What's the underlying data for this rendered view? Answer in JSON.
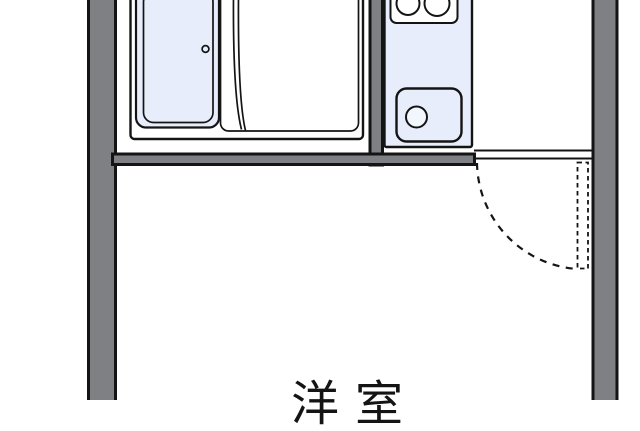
{
  "floorplan": {
    "room_labels": [
      {
        "id": "western-room",
        "label": "洋室"
      }
    ],
    "fixtures": [
      "bathtub",
      "bathtub-drain",
      "shower-partition",
      "kitchen-stove-two-burners",
      "kitchen-sink",
      "sink-drain",
      "entry-door-with-swing-arc"
    ],
    "colors": {
      "wall_fill": "#7E8084",
      "line": "#141414",
      "fixture_fill": "#E7EDFB",
      "background": "#FFFFFF"
    }
  }
}
